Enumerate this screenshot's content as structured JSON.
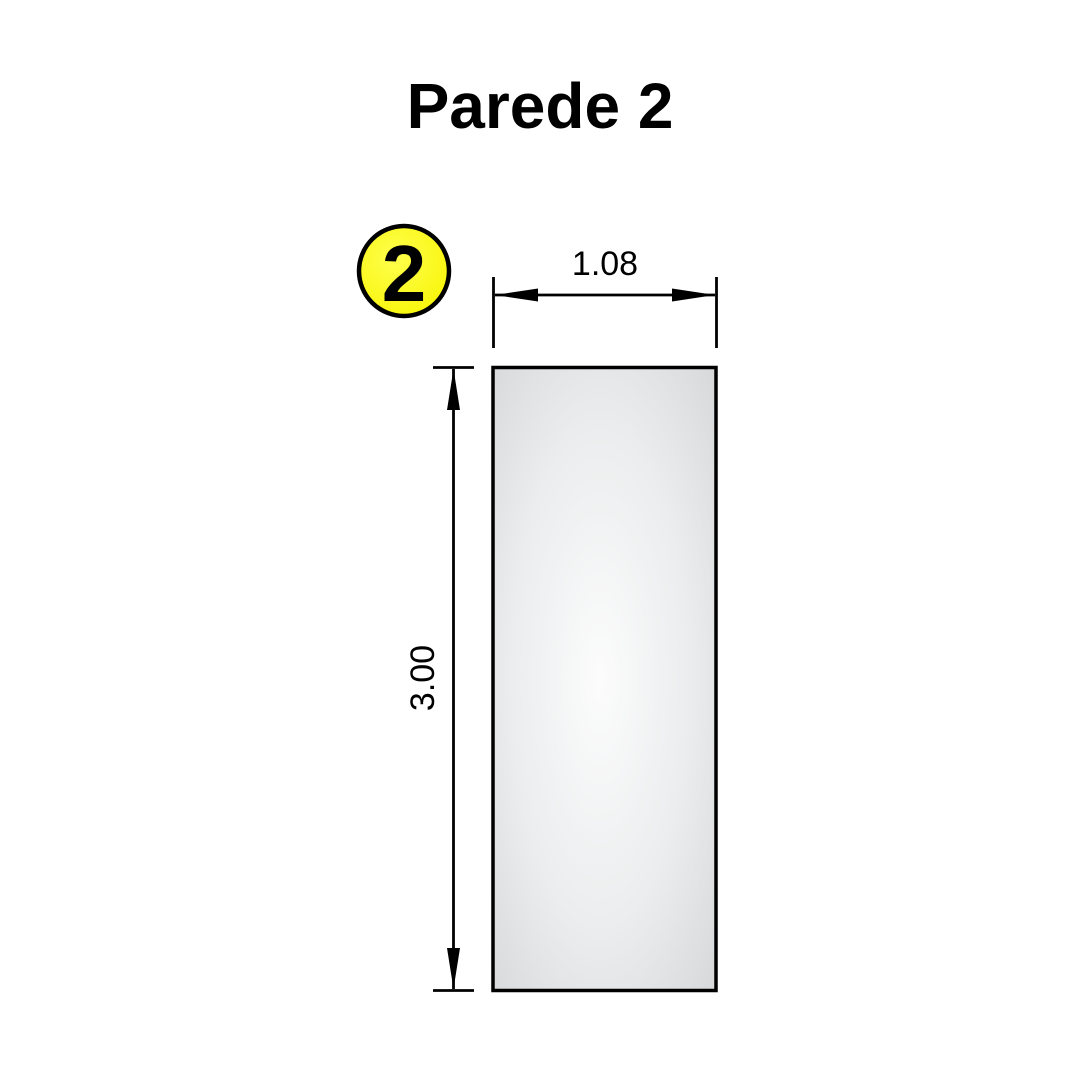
{
  "title": "Parede 2",
  "balloon": {
    "number": "2",
    "fill_center": "#ffff4d",
    "fill_edge": "#f7f400",
    "stroke": "#000000"
  },
  "wall": {
    "fill_center": "#fcfcfc",
    "fill_mid": "#ebedee",
    "fill_edge": "#d6d8da",
    "stroke": "#000000"
  },
  "dimensions": {
    "width_label": "1.08",
    "height_label": "3.00"
  },
  "colors": {
    "background": "#ffffff",
    "line": "#000000",
    "text": "#000000"
  }
}
